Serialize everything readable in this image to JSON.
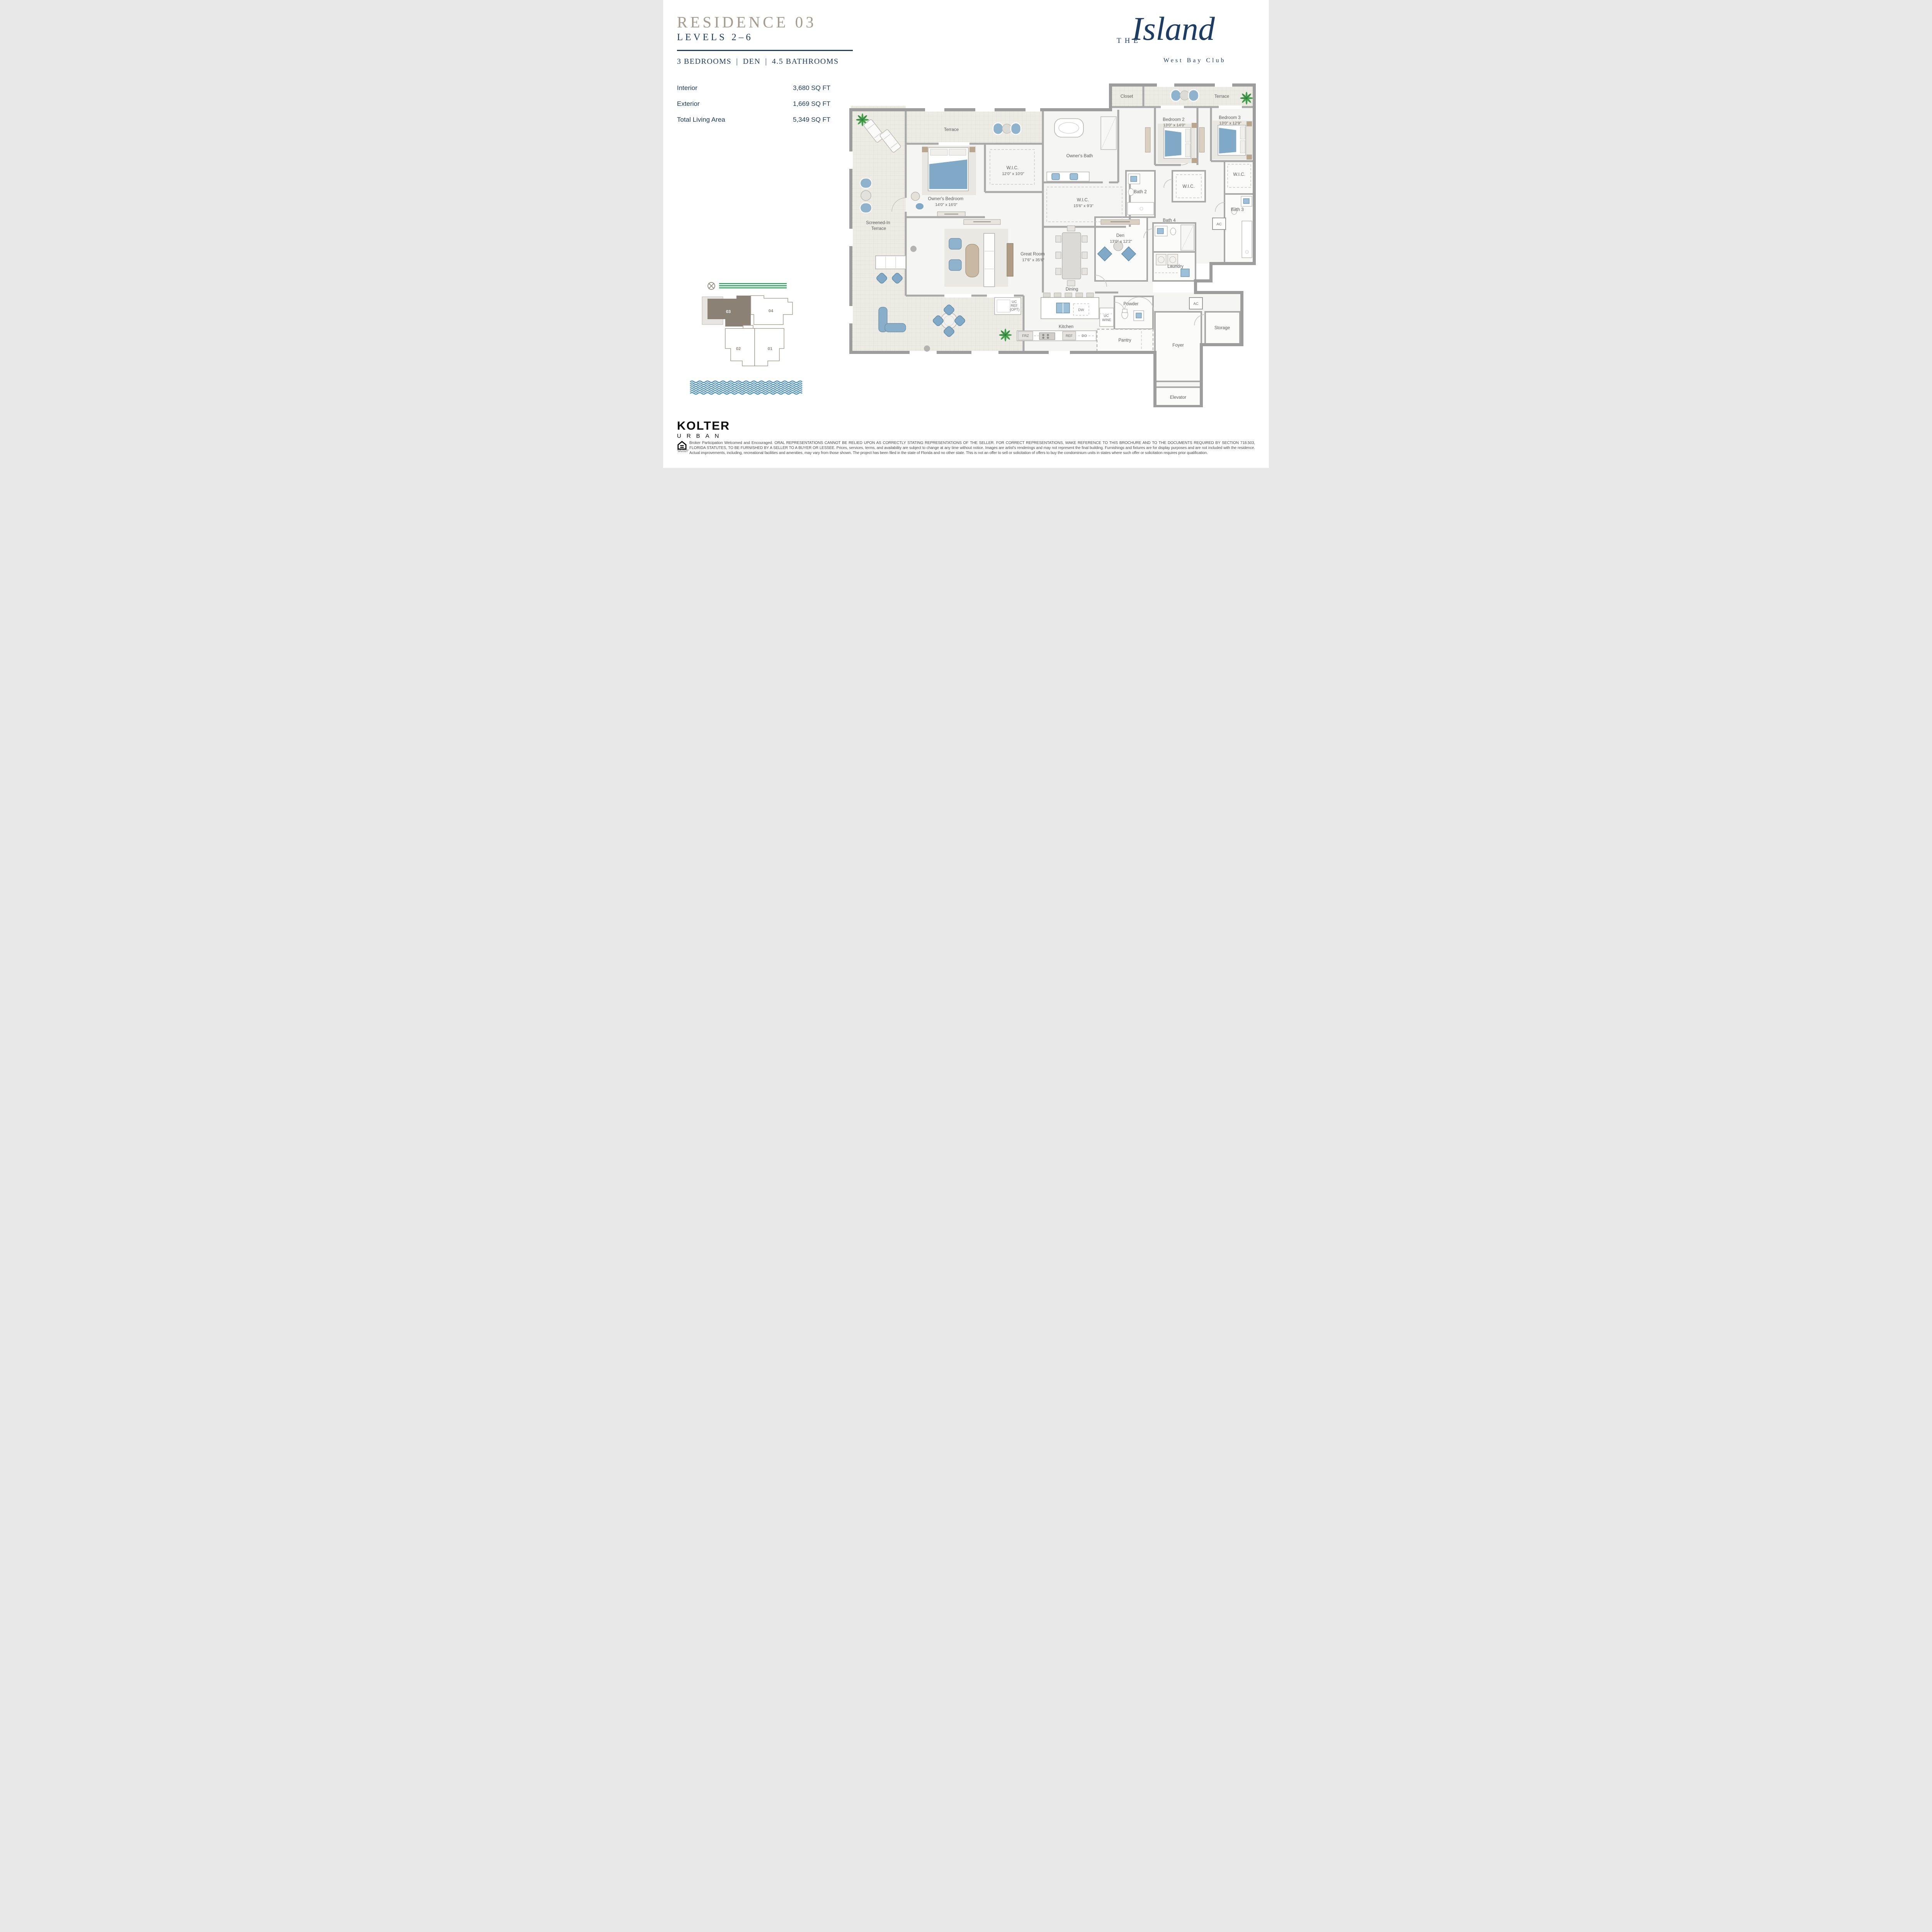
{
  "header": {
    "residence": "RESIDENCE 03",
    "levels": "LEVELS 2–6",
    "features": [
      "3 BEDROOMS",
      "DEN",
      "4.5 BATHROOMS"
    ],
    "separator": "|"
  },
  "brand": {
    "the": "THE",
    "name": "Island",
    "sub": "West Bay Club"
  },
  "areas": [
    {
      "label": "Interior",
      "value": "3,680 SQ FT"
    },
    {
      "label": "Exterior",
      "value": "1,669 SQ FT"
    },
    {
      "label": "Total Living Area",
      "value": "5,349 SQ FT"
    }
  ],
  "keyplan": {
    "units": [
      {
        "id": "03",
        "highlighted": true
      },
      {
        "id": "04",
        "highlighted": false
      },
      {
        "id": "02",
        "highlighted": false
      },
      {
        "id": "01",
        "highlighted": false
      }
    ]
  },
  "floorplan": {
    "labels": {
      "terrace_main": "Terrace",
      "terrace_tr": "Terrace",
      "closet": "Closet",
      "screened_1": "Screened-In",
      "screened_2": "Terrace",
      "owners_bedroom": "Owner's Bedroom",
      "owners_bedroom_dims": "14'0\" x 16'0\"",
      "wic_owners": "W.I.C.",
      "wic_owners_dims": "12'0\" x 10'0\"",
      "owners_bath": "Owner's Bath",
      "bedroom2": "Bedroom 2",
      "bedroom2_dims": "13'0\" x 14'0\"",
      "bedroom3": "Bedroom 3",
      "bedroom3_dims": "13'0\" x 12'9\"",
      "bath2": "Bath 2",
      "wic_b2": "W.I.C.",
      "wic_b3": "W.I.C.",
      "bath3": "Bath 3",
      "ac1": "AC",
      "wic_hall": "W.I.C.",
      "wic_hall_dims": "15'6\" x 9'3\"",
      "den": "Den",
      "den_dims": "13'0\" x 12'2\"",
      "bath4": "Bath 4",
      "laundry": "Laundry",
      "great_room": "Great Room",
      "great_room_dims": "17'6\" x 35'6\"",
      "dining": "Dining",
      "kitchen": "Kitchen",
      "powder": "Powder",
      "pantry": "Pantry",
      "foyer": "Foyer",
      "storage": "Storage",
      "ac2": "AC",
      "elevator": "Elevator",
      "uc_ref_1": "UC",
      "uc_ref_2": "REF",
      "uc_ref_3": "(OPT)",
      "uc_wine_1": "UC",
      "uc_wine_2": "WINE",
      "frz": "FRZ",
      "ref": "REF",
      "do": "DO",
      "dw": "DW"
    }
  },
  "footer": {
    "logo_line1": "KOLTER",
    "logo_line2": "URBAN",
    "equal_housing_1": "EQUAL HOUSING",
    "equal_housing_2": "OPPORTUNITY",
    "disclaimer": "Broker Participation Welcomed and Encouraged. ORAL REPRESENTATIONS CANNOT BE RELIED UPON AS CORRECTLY STATING REPRESENTATIONS OF THE SELLER. FOR CORRECT REPRESENTATIONS, MAKE REFERENCE TO THIS BROCHURE AND TO THE DOCUMENTS REQUIRED BY SECTION 718.503, FLORIDA STATUTES, TO BE FURNISHED BY A SELLER TO A BUYER OR LESSEE. Prices, services, terms, and availability are subject to change at any time without notice. Images are artist's renderings and may not represent the final building. Furnishings and fixtures are for display purposes and are not included with the residence. Actual improvements, including, recreational facilities and amenities, may vary from those shown. The project has been filed in the state of Florida and no other state. This is not an offer to sell or solicitation of offers to buy the condominium units in states where such offer or solicitation requires prior qualification."
  },
  "colors": {
    "navy": "#1d3c63",
    "taupe_title": "#a59c90",
    "unit_highlight": "#8b8175",
    "road_green": "#1a9b50",
    "water_blue": "#2d7fc0",
    "furniture_blue": "#7fa9c6"
  }
}
